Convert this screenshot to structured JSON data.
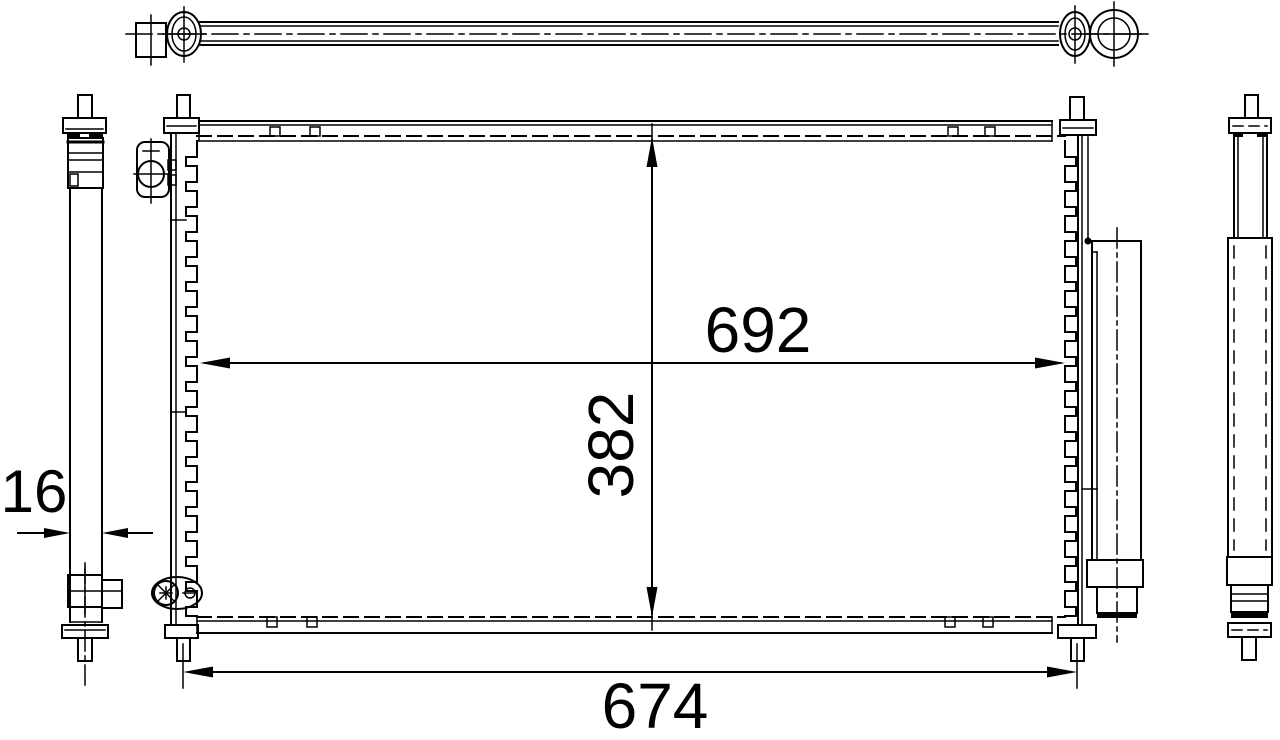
{
  "page": {
    "background_color": "#ffffff",
    "line_color": "#000000"
  },
  "drawing": {
    "dimensions": {
      "core_width_label": "692",
      "core_height_label": "382",
      "overall_width_label": "674",
      "thickness_label": "16"
    }
  }
}
